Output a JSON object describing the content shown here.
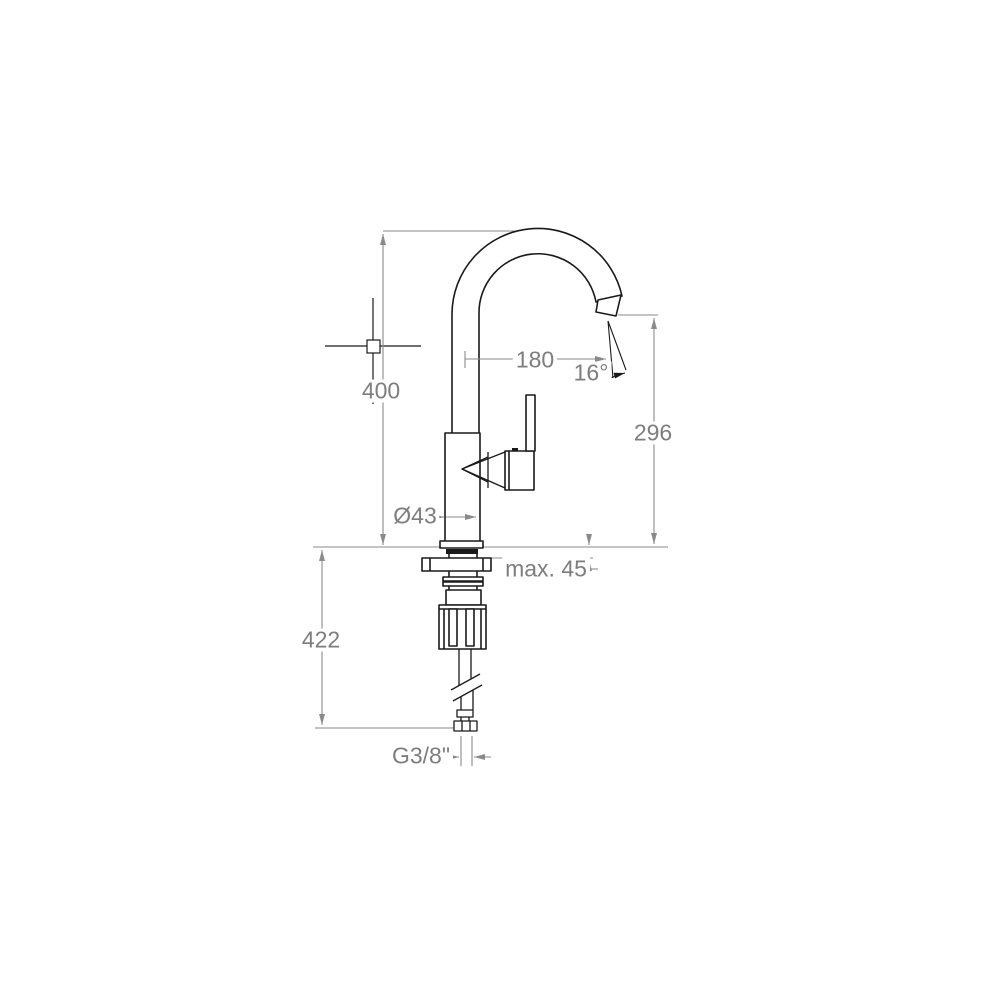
{
  "meta": {
    "type": "technical-dimension-drawing",
    "subject": "single-lever kitchen mixer tap, side elevation with installation dimensions"
  },
  "colors": {
    "background": "#ffffff",
    "outline": "#1a1a1a",
    "dimension_lines": "#8a8a8a",
    "dimension_text": "#7d7d7d"
  },
  "dimensions": {
    "total_height": "400",
    "spout_reach": "180",
    "spout_angle": "16°",
    "outlet_height": "296",
    "body_diameter": "Ø43",
    "max_deck_thickness": "max. 45",
    "under_deck_length": "422",
    "supply_connection": "G3/8\""
  }
}
